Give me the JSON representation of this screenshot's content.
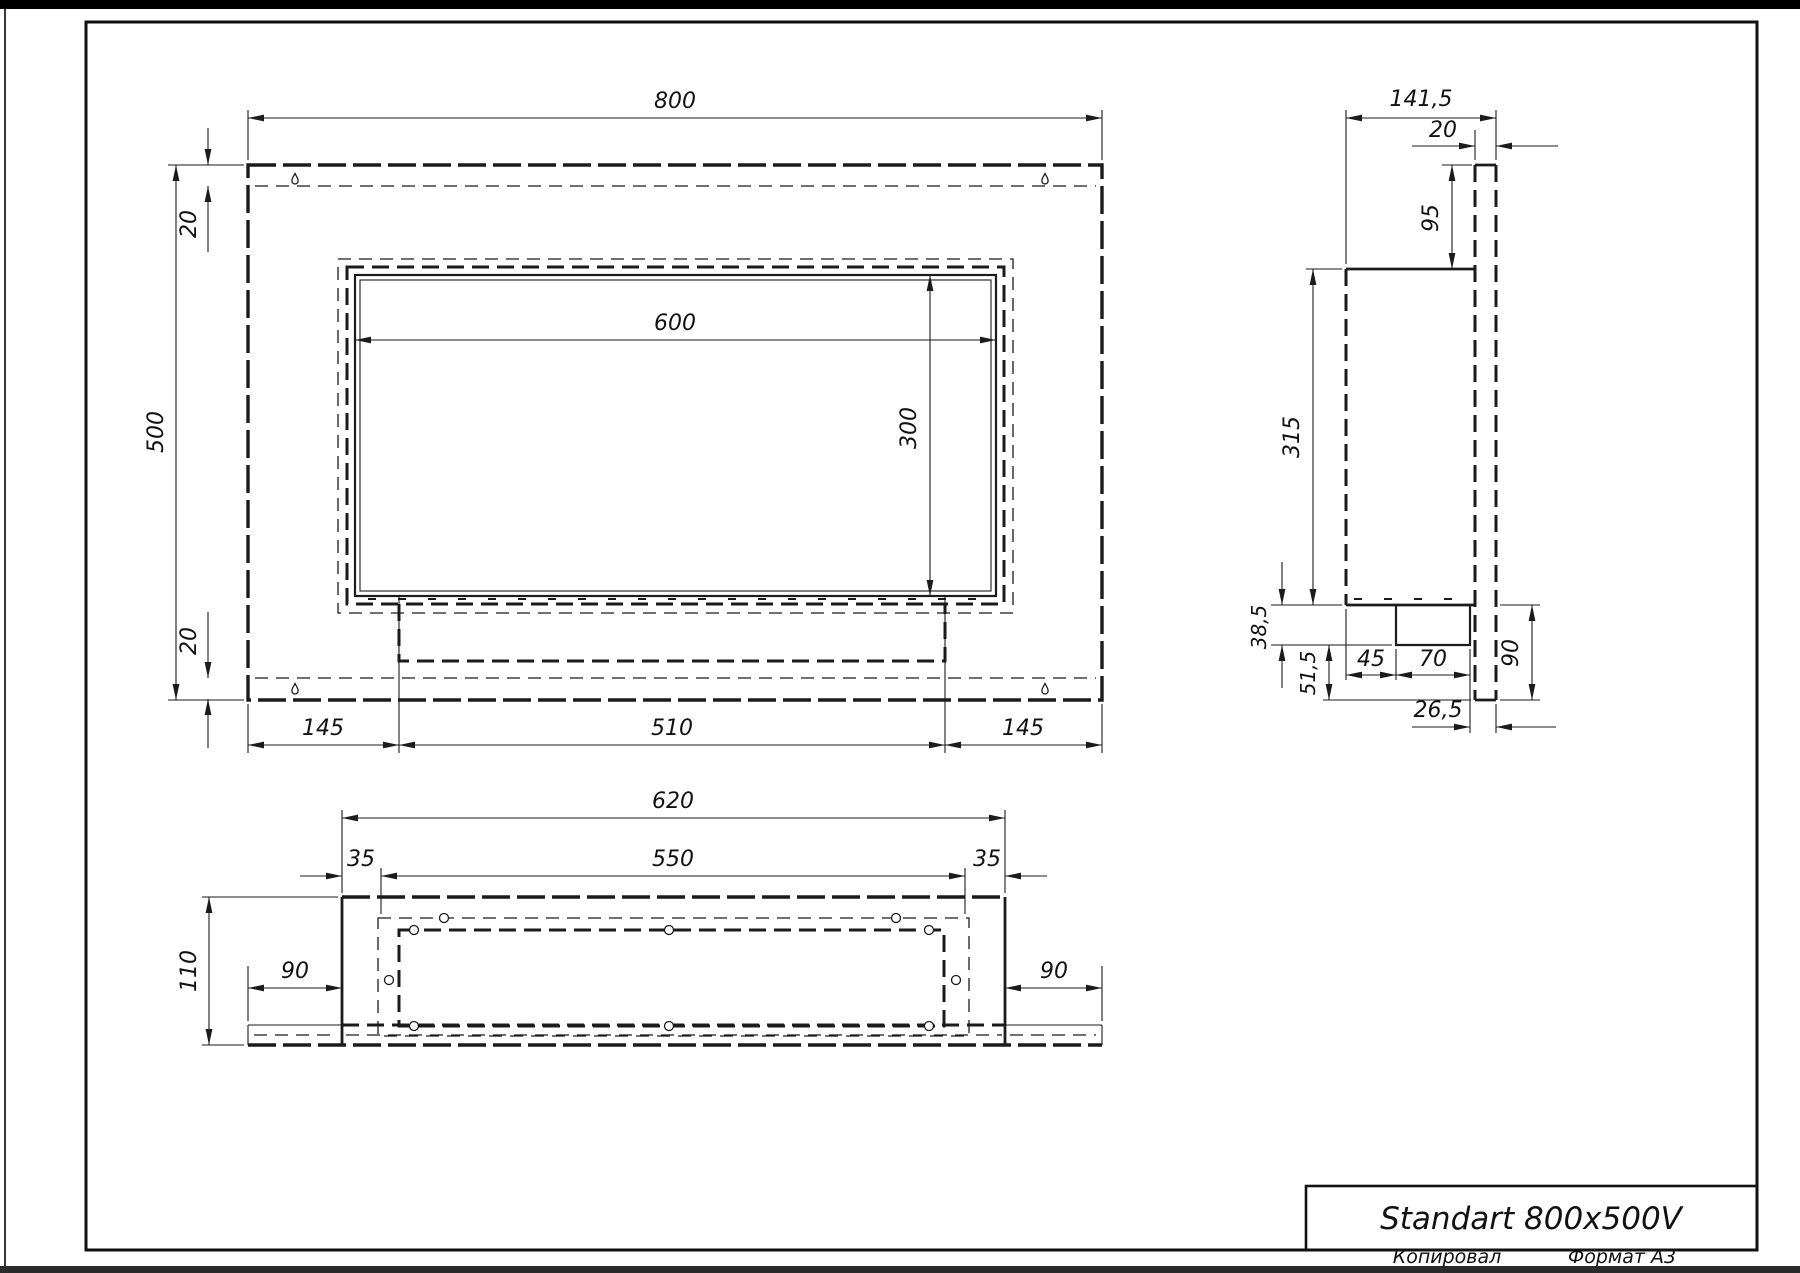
{
  "sheet": {
    "title": "Standart 800x500V",
    "footer": {
      "left": "Копировал",
      "right": "Формат А3"
    }
  },
  "front_view": {
    "dims": {
      "width": "800",
      "height": "500",
      "top_offset": "20",
      "bottom_offset": "20",
      "opening_width": "600",
      "opening_height": "300",
      "left_margin": "145",
      "tray_width": "510",
      "right_margin": "145"
    }
  },
  "side_view": {
    "dims": {
      "depth": "141,5",
      "panel_thickness": "20",
      "top_extension": "95",
      "body_height": "315",
      "burner_drop": "38,5",
      "lower_gap": "51,5",
      "front_to_burner": "45",
      "burner_depth": "70",
      "panel_below_body": "90",
      "burner_to_panel": "26,5"
    }
  },
  "bottom_view": {
    "dims": {
      "flange_width": "620",
      "tray_width": "550",
      "left_lip": "35",
      "right_lip": "35",
      "depth": "110",
      "left_margin": "90",
      "right_margin": "90"
    }
  },
  "colors": {
    "line": "#1b1b1b",
    "sheet_edge": "#000000",
    "background": "#ffffff"
  }
}
